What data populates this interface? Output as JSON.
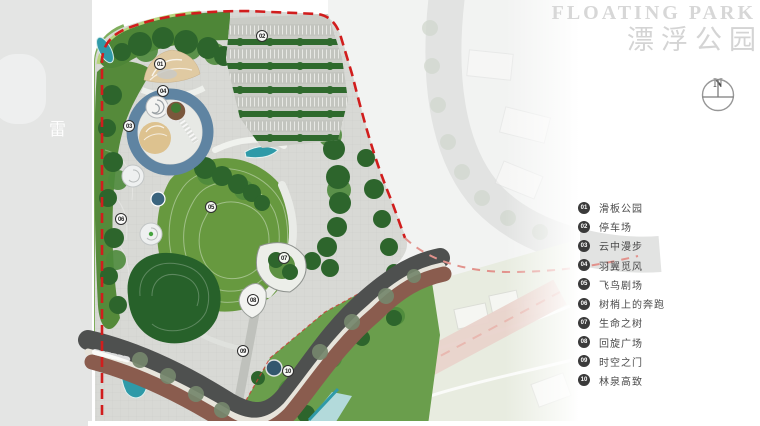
{
  "title": {
    "en": "FLOATING PARK",
    "zh": "漂浮公园"
  },
  "compass": {
    "label": "N"
  },
  "map": {
    "road_label": "雷"
  },
  "legend": {
    "items": [
      {
        "num": "01",
        "label": "滑板公园"
      },
      {
        "num": "02",
        "label": "停车场"
      },
      {
        "num": "03",
        "label": "云中漫步"
      },
      {
        "num": "04",
        "label": "羽翼觅风"
      },
      {
        "num": "05",
        "label": "飞鸟剧场"
      },
      {
        "num": "06",
        "label": "树梢上的奔跑"
      },
      {
        "num": "07",
        "label": "生命之树"
      },
      {
        "num": "08",
        "label": "回旋广场"
      },
      {
        "num": "09",
        "label": "时空之门"
      },
      {
        "num": "10",
        "label": "林泉高致"
      }
    ]
  },
  "markers": [
    {
      "num": "01"
    },
    {
      "num": "02"
    },
    {
      "num": "03"
    },
    {
      "num": "04"
    },
    {
      "num": "05"
    },
    {
      "num": "06"
    },
    {
      "num": "07"
    },
    {
      "num": "08"
    },
    {
      "num": "09"
    },
    {
      "num": "10"
    }
  ],
  "colors": {
    "boundary_red": "#d11d1d",
    "lawn_green": "#67993f",
    "tree_green": "#2d652c",
    "water_teal": "#2f9aa8",
    "pond_blue": "#33576e",
    "road_maroon": "#8a5c4e",
    "paving_gray": "#d8d9d5",
    "title_gray": "#d7d7d7"
  }
}
